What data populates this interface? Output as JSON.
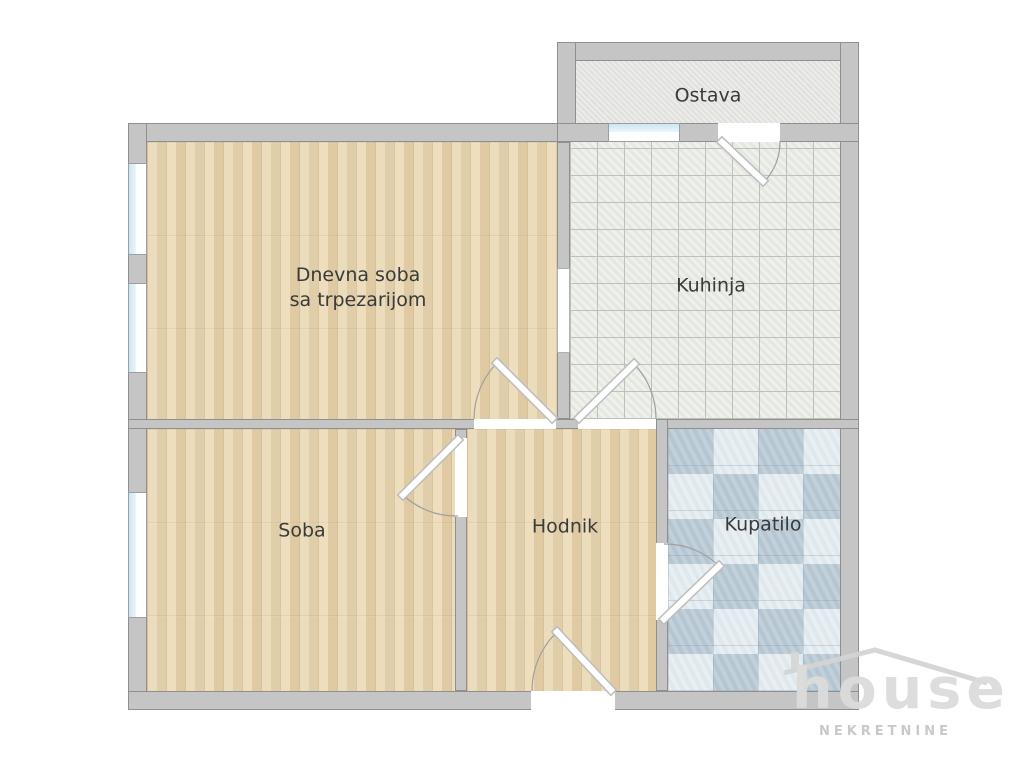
{
  "rooms": {
    "living": {
      "label_line1": "Dnevna soba",
      "label_line2": "sa trpezarijom"
    },
    "kitchen": {
      "label": "Kuhinja"
    },
    "pantry": {
      "label": "Ostava"
    },
    "bedroom": {
      "label": "Soba"
    },
    "hallway": {
      "label": "Hodnik"
    },
    "bathroom": {
      "label": "Kupatilo"
    }
  },
  "logo": {
    "brand": "house",
    "subtitle": "NEKRETNINE"
  },
  "colors": {
    "wall_fill": "#c5c5c5",
    "wall_edge": "#8f8f8f",
    "wood_floor": "#e8d6b0",
    "kitchen_tile": "#e9ece5",
    "kitchen_grid": "#bcc2b8",
    "bath_tile": "#cfdde6",
    "pantry_floor": "#e4e4e1",
    "window_glass": "#cde6f2",
    "label_text": "#3a3a3a",
    "logo_gray": "#dcdcdc"
  }
}
